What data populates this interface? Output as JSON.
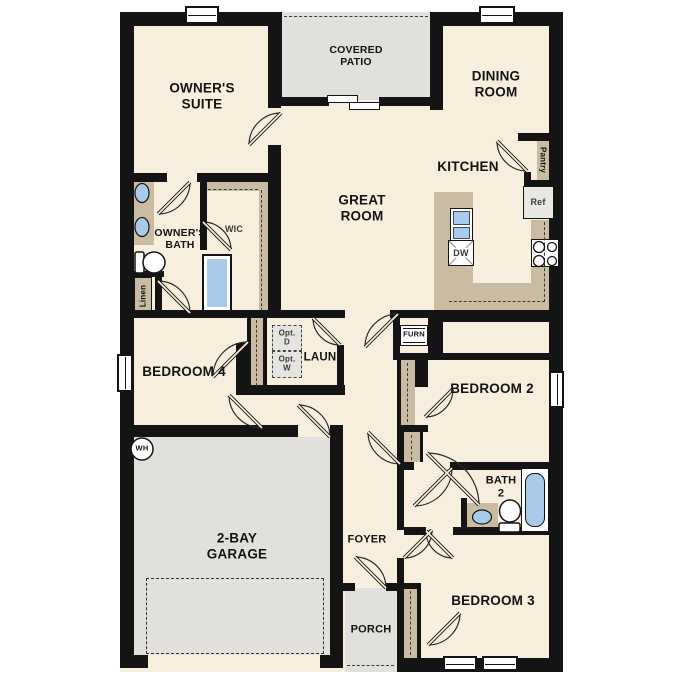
{
  "colors": {
    "wall": "#141414",
    "floor": "#f7eedd",
    "hard": "#e1e0dc",
    "counter": "#c9bca2",
    "blue": "#a9cbe9",
    "opt": "#e5e4e0",
    "appliance": "#e9e8e5"
  },
  "rooms": {
    "owners_suite": [
      "OWNER'S",
      "SUITE"
    ],
    "covered_patio": [
      "COVERED",
      "PATIO"
    ],
    "dining_room": [
      "DINING",
      "ROOM"
    ],
    "great_room": [
      "GREAT",
      "ROOM"
    ],
    "kitchen": [
      "KITCHEN"
    ],
    "owners_bath": [
      "OWNER'S",
      "BATH"
    ],
    "wic": [
      "WIC"
    ],
    "laundry": [
      "LAUN"
    ],
    "bedroom_4": [
      "BEDROOM 4"
    ],
    "bedroom_2": [
      "BEDROOM 2"
    ],
    "bedroom_3": [
      "BEDROOM 3"
    ],
    "bath_2": [
      "BATH",
      "2"
    ],
    "garage": [
      "2-BAY",
      "GARAGE"
    ],
    "foyer": [
      "FOYER"
    ],
    "porch": [
      "PORCH"
    ]
  },
  "features": {
    "pantry": "Pantry",
    "ref": "Ref",
    "dw": "DW",
    "furn": "FURN",
    "opt_d": [
      "Opt.",
      "D"
    ],
    "opt_w": [
      "Opt.",
      "W"
    ],
    "linen": "Linen",
    "water_heater": "WH"
  }
}
